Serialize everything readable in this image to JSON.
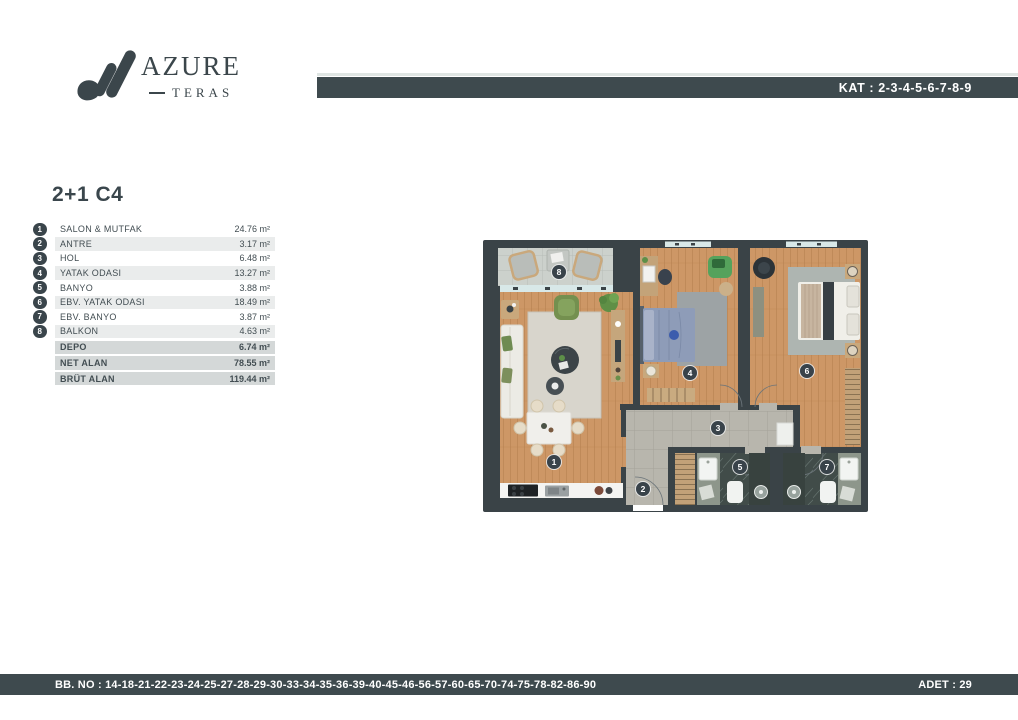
{
  "brand": {
    "name": "AZURE",
    "sub": "TERAS"
  },
  "top_bar": {
    "kat": "KAT : 2-3-4-5-6-7-8-9"
  },
  "unit": {
    "title": "2+1 C4"
  },
  "room_table": {
    "rooms": [
      {
        "no": "1",
        "label": "SALON & MUTFAK",
        "area": "24.76 m²"
      },
      {
        "no": "2",
        "label": "ANTRE",
        "area": "3.17 m²"
      },
      {
        "no": "3",
        "label": "HOL",
        "area": "6.48 m²"
      },
      {
        "no": "4",
        "label": "YATAK ODASI",
        "area": "13.27 m²"
      },
      {
        "no": "5",
        "label": "BANYO",
        "area": "3.88 m²"
      },
      {
        "no": "6",
        "label": "EBV. YATAK ODASI",
        "area": "18.49 m²"
      },
      {
        "no": "7",
        "label": "EBV. BANYO",
        "area": "3.87 m²"
      },
      {
        "no": "8",
        "label": "BALKON",
        "area": "4.63 m²"
      }
    ],
    "summary": [
      {
        "label": "DEPO",
        "area": "6.74 m²"
      },
      {
        "label": "NET ALAN",
        "area": "78.55 m²"
      },
      {
        "label": "BRÜT ALAN",
        "area": "119.44 m²"
      }
    ]
  },
  "floorplan": {
    "badges": [
      "1",
      "2",
      "3",
      "4",
      "5",
      "6",
      "7",
      "8"
    ]
  },
  "footer": {
    "bb_no": "BB. NO : 14-18-21-22-23-24-25-27-28-29-30-33-34-35-36-39-40-45-46-56-57-60-65-70-74-75-78-82-86-90",
    "adet": "ADET : 29"
  },
  "colors": {
    "accent": "#3e4a4e",
    "wall": "#3a4347",
    "wood": "#cc9767",
    "hall_tile": "#b8b6ad",
    "balcony_tile": "#ccd1cc",
    "bath_marble": "#414c49"
  }
}
